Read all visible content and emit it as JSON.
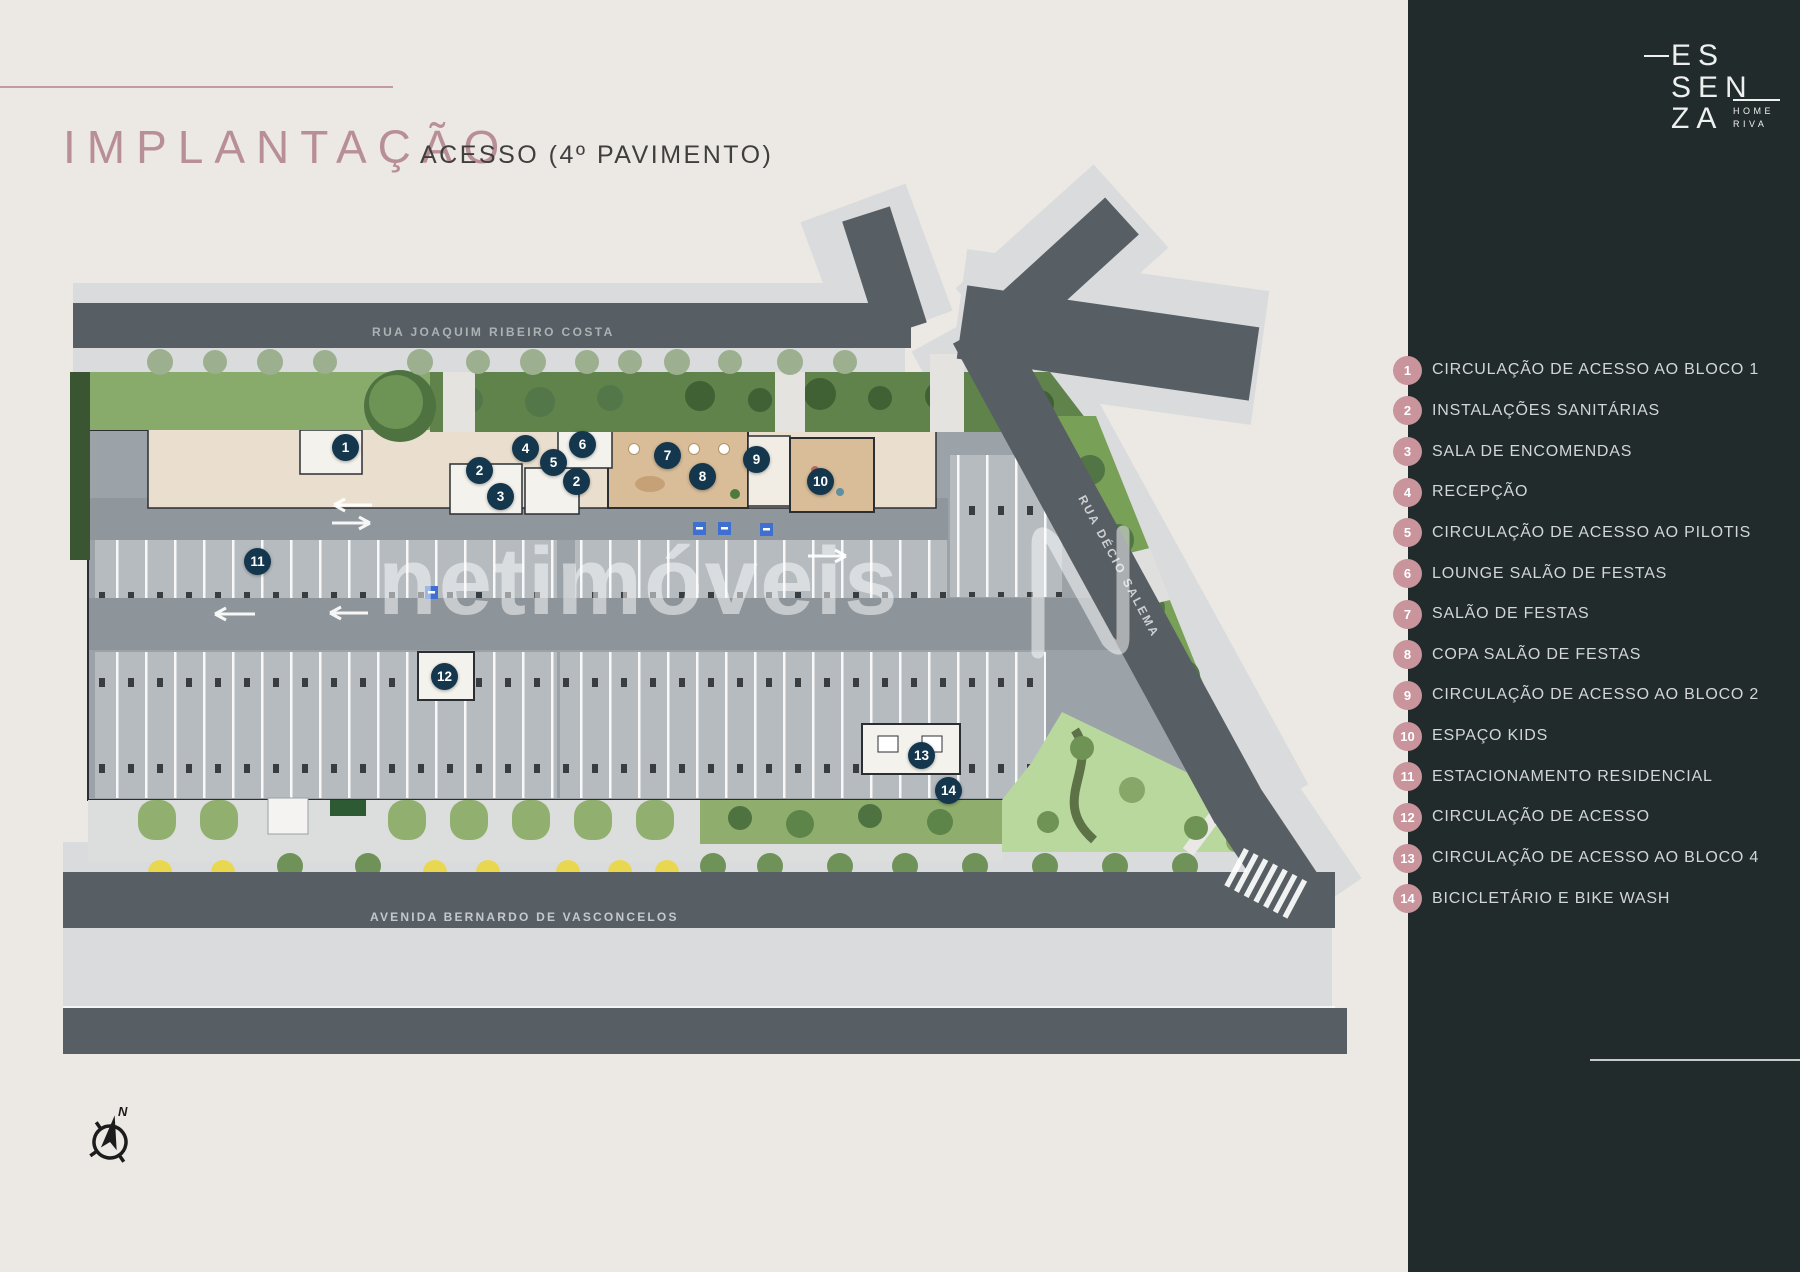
{
  "header": {
    "title": "IMPLANTAÇÃO",
    "subtitle": "ACESSO (4º PAVIMENTO)"
  },
  "logo": {
    "line1": "ES",
    "line2": "SEN",
    "line3": "ZA",
    "sub1": "HOME",
    "sub2": "RIVA"
  },
  "plan": {
    "streets": {
      "top": "RUA JOAQUIM RIBEIRO COSTA",
      "right": "RUA DÉCIO SALEMA",
      "bottom": "AVENIDA BERNARDO DE VASCONCELOS"
    },
    "watermark": "netimóveis",
    "compass_n": "N",
    "markers": [
      {
        "number": "1"
      },
      {
        "number": "2"
      },
      {
        "number": "3"
      },
      {
        "number": "4"
      },
      {
        "number": "5"
      },
      {
        "number": "2"
      },
      {
        "number": "6"
      },
      {
        "number": "7"
      },
      {
        "number": "8"
      },
      {
        "number": "9"
      },
      {
        "number": "10"
      },
      {
        "number": "11"
      },
      {
        "number": "12"
      },
      {
        "number": "13"
      },
      {
        "number": "14"
      }
    ]
  },
  "legend": {
    "items": [
      {
        "number": "1",
        "label": "CIRCULAÇÃO DE ACESSO AO BLOCO 1"
      },
      {
        "number": "2",
        "label": "INSTALAÇÕES SANITÁRIAS"
      },
      {
        "number": "3",
        "label": "SALA DE ENCOMENDAS"
      },
      {
        "number": "4",
        "label": "RECEPÇÃO"
      },
      {
        "number": "5",
        "label": "CIRCULAÇÃO DE ACESSO AO PILOTIS"
      },
      {
        "number": "6",
        "label": "LOUNGE SALÃO DE FESTAS"
      },
      {
        "number": "7",
        "label": "SALÃO DE FESTAS"
      },
      {
        "number": "8",
        "label": "COPA SALÃO DE FESTAS"
      },
      {
        "number": "9",
        "label": "CIRCULAÇÃO DE ACESSO AO BLOCO 2"
      },
      {
        "number": "10",
        "label": "ESPAÇO KIDS"
      },
      {
        "number": "11",
        "label": "ESTACIONAMENTO RESIDENCIAL"
      },
      {
        "number": "12",
        "label": "CIRCULAÇÃO DE ACESSO"
      },
      {
        "number": "13",
        "label": "CIRCULAÇÃO DE ACESSO AO BLOCO 4"
      },
      {
        "number": "14",
        "label": "BICICLETÁRIO E BIKE WASH"
      }
    ]
  },
  "colors": {
    "background": "#ece9e4",
    "sidebar": "#212b2b",
    "accent_rose": "#b98f97",
    "legend_circle": "#c9949c",
    "plan_marker": "#14374d",
    "asphalt": "#575e64",
    "sidewalk": "#d9dbdd"
  }
}
